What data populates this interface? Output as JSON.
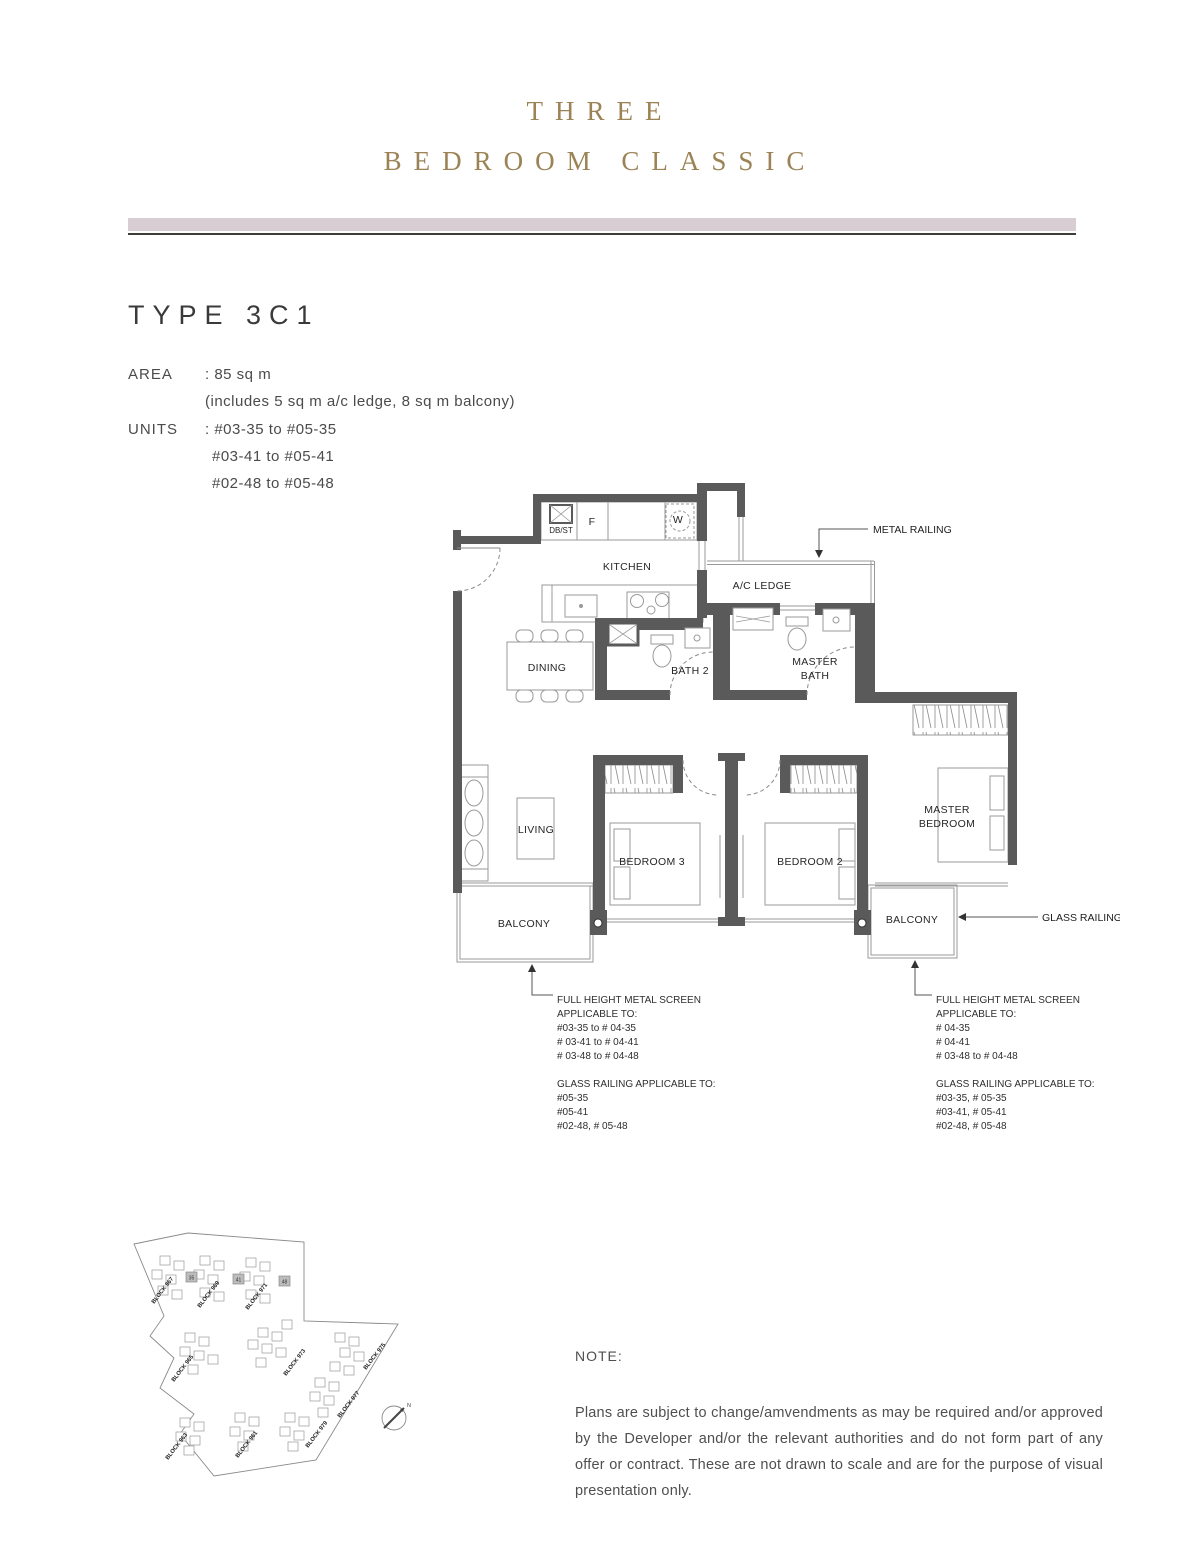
{
  "header": {
    "title_line1": "THREE",
    "title_line2": "BEDROOM CLASSIC"
  },
  "unit_info": {
    "type_heading": "TYPE 3C1",
    "area_label": "AREA",
    "area_value": ": 85 sq m",
    "area_note": "(includes 5 sq m a/c ledge, 8 sq m balcony)",
    "units_label": "UNITS",
    "units_line1": ": #03-35 to #05-35",
    "units_line2": "#03-41 to #05-41",
    "units_line3": "#02-48 to #05-48"
  },
  "floorplan": {
    "labels": {
      "dbst": "DB/ST",
      "fridge": "F",
      "washer": "W",
      "kitchen": "KITCHEN",
      "ac_ledge": "A/C LEDGE",
      "dining": "DINING",
      "bath2": "BATH 2",
      "master_bath_1": "MASTER",
      "master_bath_2": "BATH",
      "living": "LIVING",
      "bedroom3": "BEDROOM 3",
      "bedroom2": "BEDROOM 2",
      "master_bedroom_1": "MASTER",
      "master_bedroom_2": "BEDROOM",
      "balcony_left": "BALCONY",
      "balcony_right": "BALCONY",
      "metal_railing": "METAL RAILING",
      "glass_railing": "GLASS RAILING"
    },
    "left_annotation": {
      "screen_lines": [
        "FULL HEIGHT METAL SCREEN",
        "APPLICABLE TO:",
        "#03-35 to # 04-35",
        "# 03-41 to # 04-41",
        "# 03-48 to # 04-48"
      ],
      "glass_lines": [
        "GLASS RAILING APPLICABLE TO:",
        "#05-35",
        "#05-41",
        "#02-48, # 05-48"
      ]
    },
    "right_annotation": {
      "screen_lines": [
        "FULL HEIGHT METAL SCREEN",
        "APPLICABLE TO:",
        "# 04-35",
        "# 04-41",
        "# 03-48 to # 04-48"
      ],
      "glass_lines": [
        "GLASS RAILING APPLICABLE TO:",
        "#03-35, # 05-35",
        "#03-41, # 05-41",
        "#02-48, # 05-48"
      ]
    }
  },
  "siteplan": {
    "blocks": [
      "BLOCK 967",
      "BLOCK 969",
      "BLOCK 971",
      "BLOCK 973",
      "BLOCK 975",
      "BLOCK 977",
      "BLOCK 979",
      "BLOCK 965",
      "BLOCK 963",
      "BLOCK 961"
    ],
    "highlighted_units": [
      "35",
      "41",
      "48"
    ],
    "compass_label": "N"
  },
  "note": {
    "label": "NOTE:",
    "body": "Plans are subject to change/amvendments as may be required and/or approved by the Developer and/or the relevant authorities and do not form part of any offer or contract. These are not drawn to scale and are for the purpose of visual presentation only."
  },
  "colors": {
    "accent_gold": "#9b8355",
    "divider_pink": "#d9cdd4",
    "wall_gray": "#5a5a5a"
  }
}
